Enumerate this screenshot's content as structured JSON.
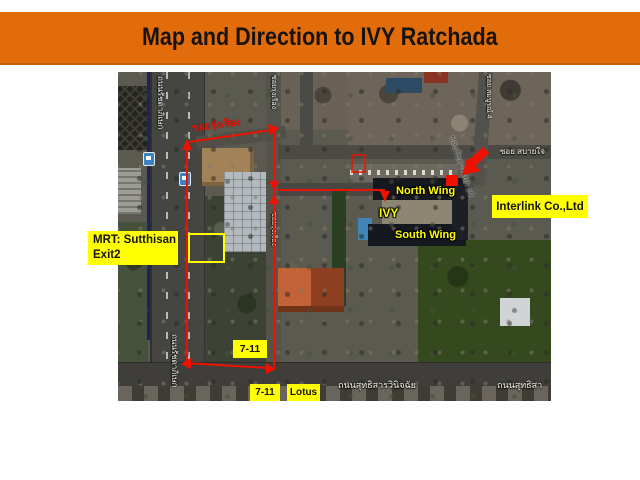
{
  "theme": {
    "banner-orange": "#e36c0a",
    "banner-edge": "#c05e07",
    "annotation-red": "#ee1100",
    "label-yellow": "#ffff00"
  },
  "banner": {
    "title": "Map and Direction to IVY Ratchada"
  },
  "map_labels": {
    "mrt_line1": "MRT: Sutthisan",
    "mrt_line2": "Exit2",
    "interlink": "Interlink Co.,Ltd",
    "north_wing": "North Wing",
    "ivy": "IVY",
    "south_wing": "South Wing",
    "seven_eleven_mid": "7-11",
    "seven_eleven_bottom": "7-11",
    "lotus": "Lotus"
  },
  "streets": {
    "ratchadaphisek_upper": "ถนนรัชดาภิเษก",
    "ratchadaphisek_lower": "ถนนรัชดาภิเษก",
    "soi_rungruang": "ซอยรุ่งเรือง",
    "soi_vertical_top": "ซอยรุ่งเรือง",
    "soi_vertical_mid": "ซอยรุ่งเรือง",
    "soi_sabaijai": "ซอย สบายใจ",
    "soi_somboon": "ซอย สมบูรณ์ 4",
    "soi_ratchada_20": "ซอยรัชดาภิเษก 20",
    "sutthisan_left": "ถนนสุทธิสารวินิจฉัย",
    "sutthisan_right": "ถนนสุทธิสา"
  }
}
